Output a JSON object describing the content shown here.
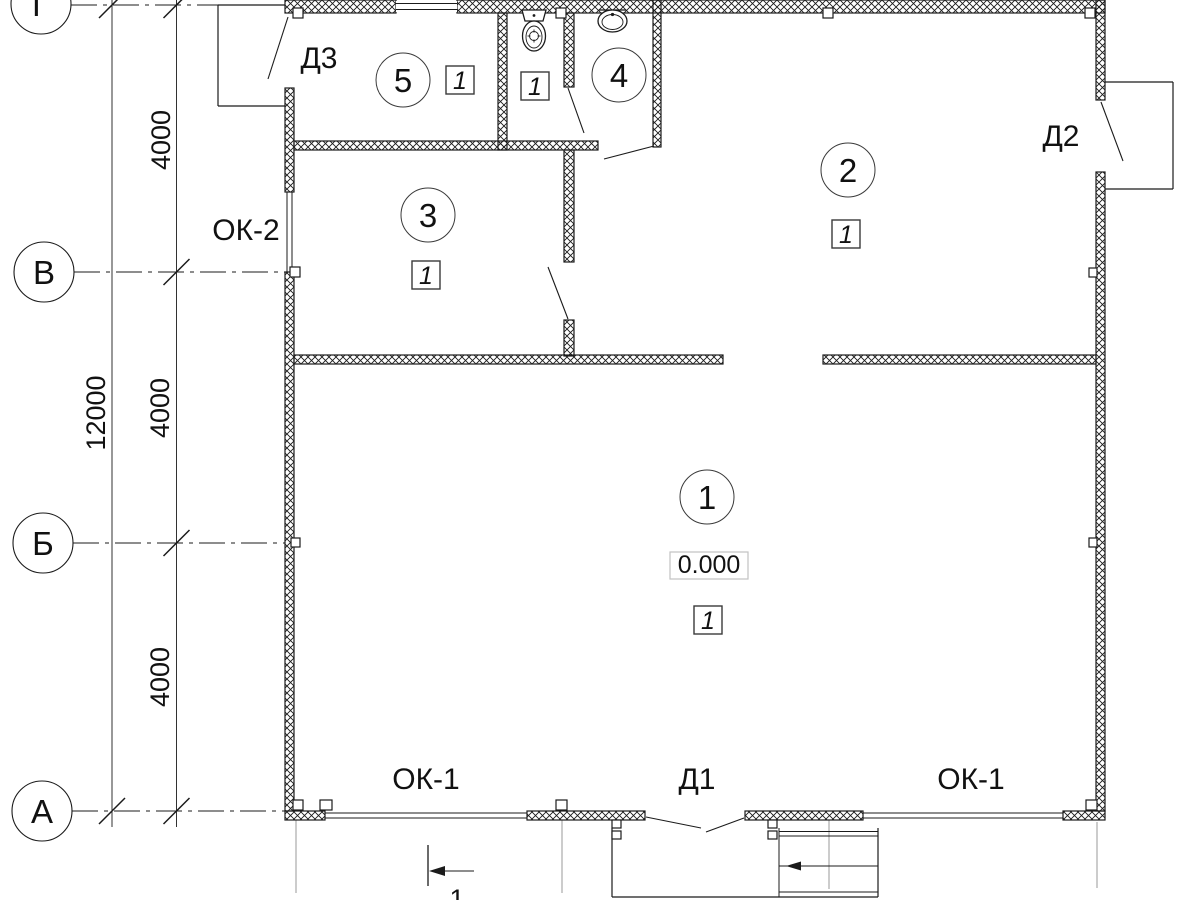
{
  "plan": {
    "axis_rows": {
      "g": "Г",
      "v": "В",
      "b": "Б",
      "a": "А"
    },
    "dims": {
      "seg_top": "4000",
      "seg_mid": "4000",
      "seg_bot": "4000",
      "total": "12000"
    },
    "rooms": {
      "r1": "1",
      "r2": "2",
      "r3": "3",
      "r4": "4",
      "r5": "5"
    },
    "marks": {
      "m1": "1",
      "m2": "1",
      "m3": "1",
      "m4": "1",
      "m5": "1"
    },
    "elevation": "0.000",
    "doors": {
      "d1": "Д1",
      "d2": "Д2",
      "d3": "Д3"
    },
    "windows": {
      "ok1_left": "ОК-1",
      "ok1_right": "ОК-1",
      "ok2": "ОК-2"
    },
    "section_mark": "1"
  }
}
